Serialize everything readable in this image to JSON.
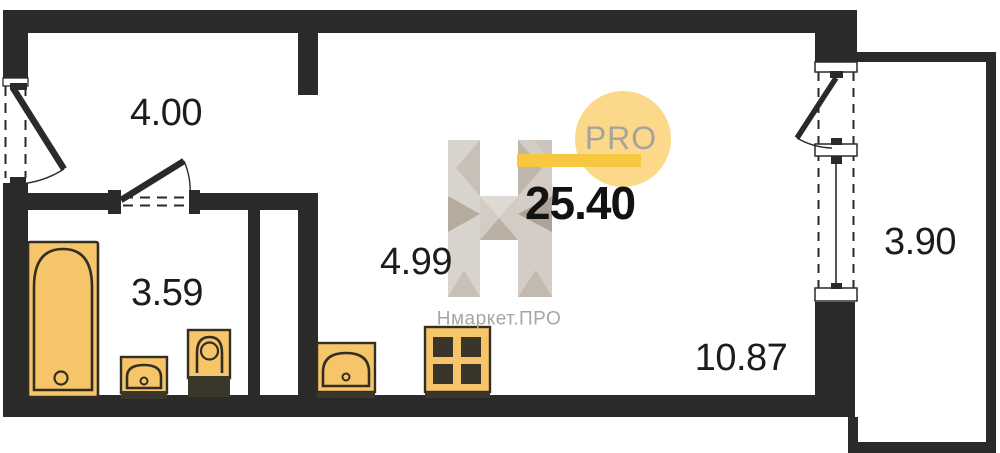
{
  "plan": {
    "type": "apartment-floor-plan",
    "labels": {
      "hallway": "4.00",
      "bathroom": "3.59",
      "kitchen": "4.99",
      "total": "25.40",
      "living": "10.87",
      "balcony": "3.90"
    },
    "fixtures": [
      "bathtub",
      "bathroom-sink",
      "toilet",
      "kitchen-sink",
      "stove"
    ],
    "openings": [
      "entrance-door",
      "bathroom-door",
      "balcony-door",
      "window"
    ]
  },
  "watermark": {
    "letter_mark": "H",
    "pro_label": "PRO",
    "brand_name": "Нмаркет.ПРО"
  },
  "colors": {
    "wall": "#2a2a28",
    "fixture_fill": "#f6c469",
    "fixture_stroke": "#332e24",
    "fixture_dark": "#3b362b",
    "logo_circle": "#fcd98a",
    "logo_bar": "#f6c73f",
    "logo_gray_light": "#d8d3cc",
    "logo_gray_mid": "#c7bfb5",
    "logo_gray_dark": "#b3a99d",
    "label_text": "#1c1c1c",
    "muted_text": "#a9a6a1",
    "background": "#ffffff"
  }
}
